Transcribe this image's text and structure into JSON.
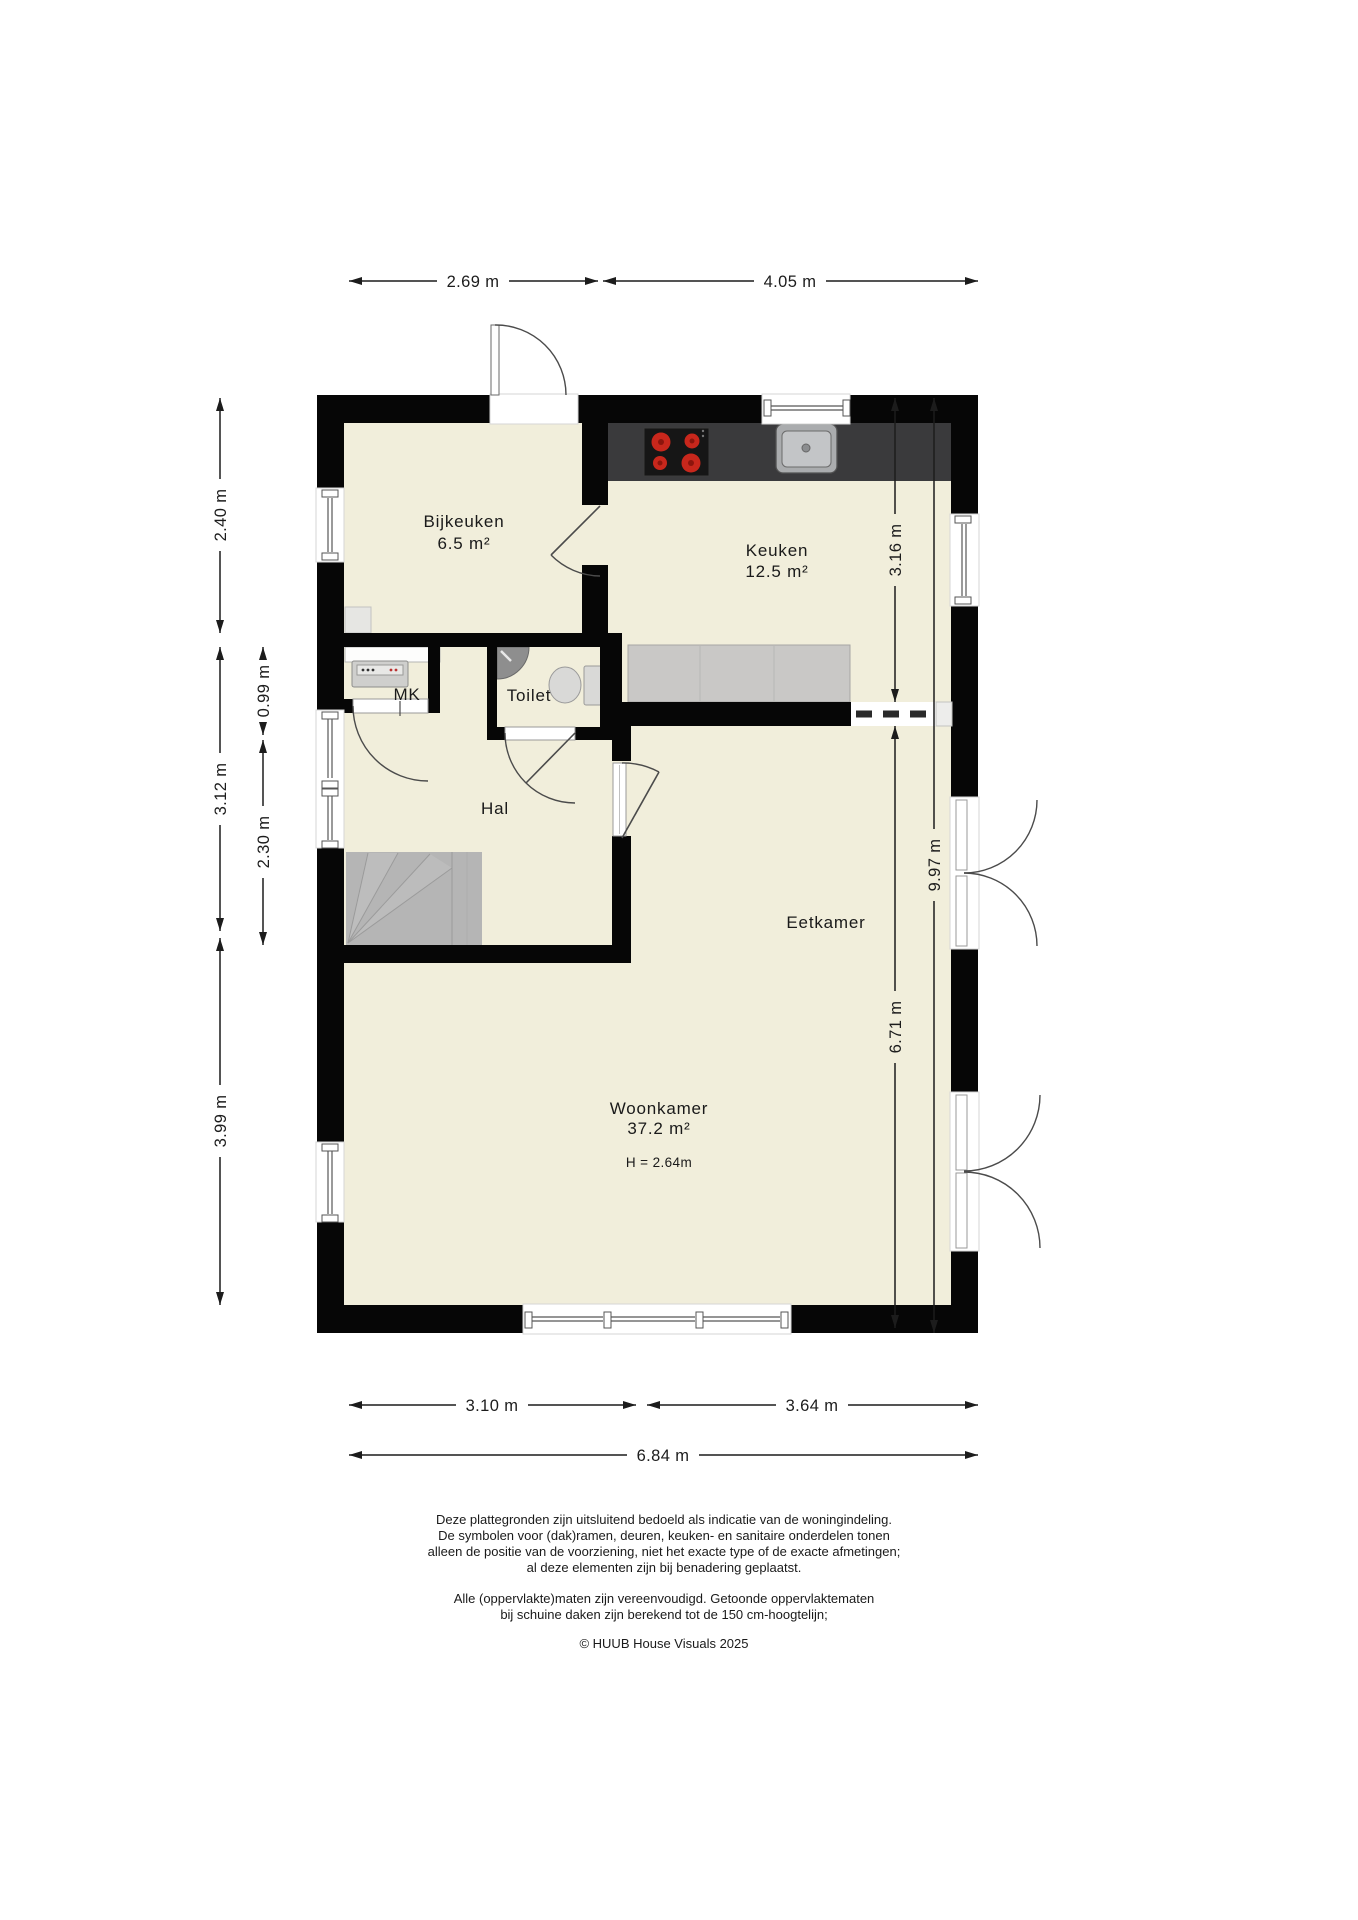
{
  "rooms": {
    "bijkeuken": {
      "label": "Bijkeuken",
      "area": "6.5 m²"
    },
    "keuken": {
      "label": "Keuken",
      "area": "12.5 m²"
    },
    "mk": {
      "label": "MK"
    },
    "toilet": {
      "label": "Toilet"
    },
    "hal": {
      "label": "Hal"
    },
    "eetkamer": {
      "label": "Eetkamer"
    },
    "woonkamer": {
      "label": "Woonkamer",
      "area": "37.2 m²",
      "height_note": "H = 2.64m"
    }
  },
  "dimensions": {
    "top": [
      {
        "value": "2.69 m"
      },
      {
        "value": "4.05 m"
      }
    ],
    "bottom": [
      {
        "value": "3.10 m"
      },
      {
        "value": "3.64 m"
      },
      {
        "value": "6.84 m"
      }
    ],
    "left_outer": [
      {
        "value": "2.40 m"
      },
      {
        "value": "3.12 m"
      },
      {
        "value": "3.99 m"
      }
    ],
    "left_inner": [
      {
        "value": "0.99 m"
      },
      {
        "value": "2.30 m"
      }
    ],
    "right_inner": [
      {
        "value": "3.16 m"
      },
      {
        "value": "6.71 m"
      }
    ],
    "right_outer": [
      {
        "value": "9.97 m"
      }
    ]
  },
  "fixtures": [
    "stove-icon",
    "sink-icon",
    "toilet-icon",
    "corner-basin-icon",
    "meter-cabinet-icon",
    "stairs",
    "door-swing",
    "window",
    "french-doors",
    "open-passage-dashed"
  ],
  "colors": {
    "floor": "#f1eedb",
    "wall": "#060606",
    "counter_dark": "#3a3a3c",
    "counter_light": "#c9c8c6",
    "stairs": "#b5b5b5",
    "fixture_gray": "#d9d9d7",
    "burner_red": "#c8271c"
  },
  "disclaimer": {
    "lines": [
      "Deze plattegronden zijn uitsluitend bedoeld als indicatie van de woningindeling.",
      "De symbolen voor (dak)ramen, deuren, keuken- en sanitaire onderdelen tonen",
      "alleen de positie van de voorziening, niet het exacte type of de exacte afmetingen;",
      "al deze elementen zijn bij benadering geplaatst.",
      "Alle (oppervlakte)maten zijn vereenvoudigd. Getoonde oppervlaktematen",
      "bij schuine daken zijn berekend tot de 150 cm-hoogtelijn;"
    ],
    "copyright": "© HUUB House Visuals 2025"
  }
}
